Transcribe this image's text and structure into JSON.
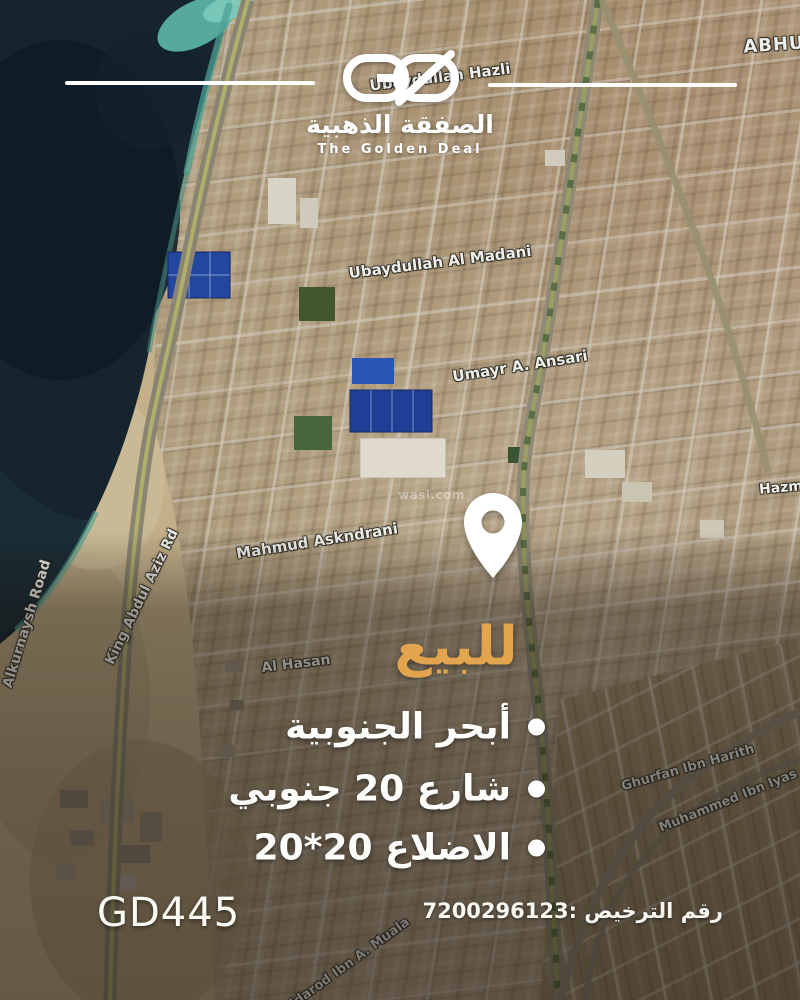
{
  "brand": {
    "monogram": "GD",
    "name_ar": "الصفقة الذهبية",
    "name_en": "The Golden Deal"
  },
  "listing": {
    "for_sale": "للبيع",
    "features": [
      "أبحر الجنوبية",
      "شارع 20 جنوبي",
      "الاضلاع 20*20"
    ],
    "ref_code": "GD445",
    "license_text": "رقم الترخيص :7200296123"
  },
  "map": {
    "street_labels": [
      "Ubaydullah Hazli",
      "ABHU",
      "Ubaydullah Al Madani",
      "Umayr A. Ansari",
      "Mahmud Askndrani",
      "Al Hasan",
      "Hazm",
      "King Abdul Aziz Rd",
      "Alkurnaysh Road",
      "Ghurfan Ibn Harith",
      "Muhammed Ibn Iyas",
      "Aldarod Ibn A. Muala"
    ],
    "watermark": "wasl.com"
  },
  "colors": {
    "gold": "#e2a54e",
    "sea": "#16242e",
    "turquoise": "#58b2a1",
    "sand": "#c3b08a"
  }
}
